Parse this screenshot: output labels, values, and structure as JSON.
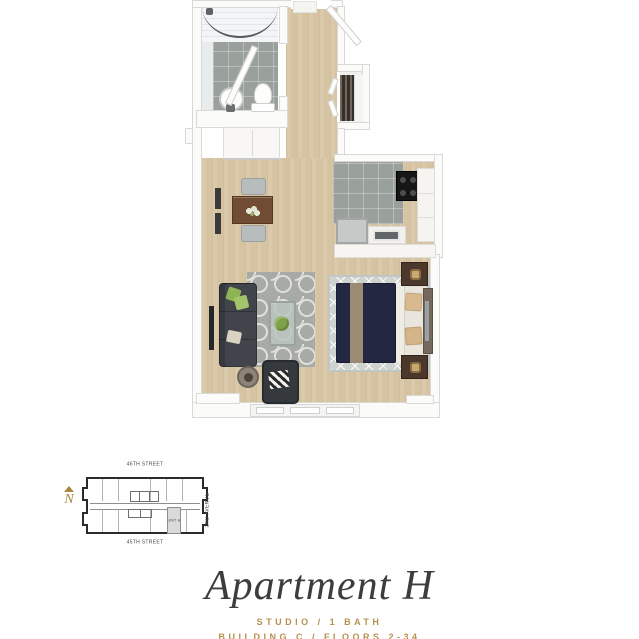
{
  "title_block": {
    "title": "Apartment H",
    "subtitle_line1": "STUDIO / 1 BATH",
    "subtitle_line2": "BUILDING C / FLOORS 2-34"
  },
  "site_map": {
    "north_label": "N",
    "street_top": "46TH STREET",
    "street_bottom": "45TH STREET",
    "avenue_right": "2ND AVENUE",
    "unit_label": "UNIT H"
  },
  "colors": {
    "accent_gold": "#b5924d",
    "title_text": "#3c3d3d",
    "wood_floor": "#d6c3a2",
    "tile_gray": "#9aa19d",
    "sofa_charcoal": "#41454b",
    "bed_navy": "#232742",
    "rug_gray": "#a7aaa5",
    "dining_table_brown": "#6f4c33",
    "nightstand_brown": "#4c382b",
    "site_plan_outline": "#2b2b29"
  }
}
